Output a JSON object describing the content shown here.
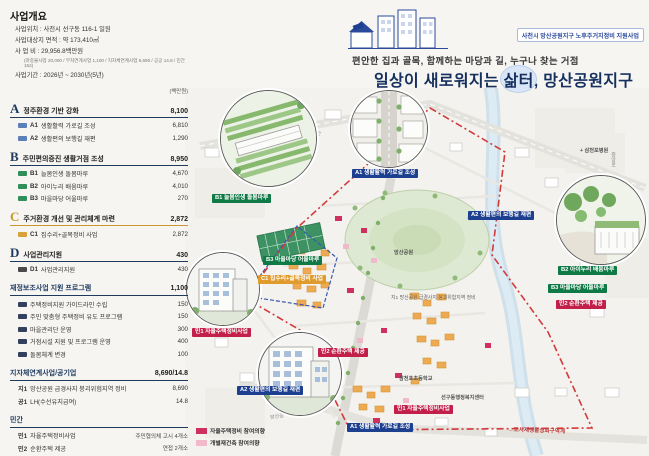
{
  "overview": {
    "title": "사업개요",
    "rows": [
      {
        "label": "사업위치",
        "value": "사천시 선구동 116-1 일원"
      },
      {
        "label": "사업대상지 면적",
        "value": "약 173,410㎡"
      },
      {
        "label": "사 업 비",
        "value": "29,956.8백만원",
        "note": "(마중물사업 20,000 / 부처연계사업 1,100 / 지자체연계사업 8,690 / 공공 14.8 / 민간 152)"
      },
      {
        "label": "사업기간",
        "value": "2026년 ~ 2030년(5년)"
      }
    ]
  },
  "budget": {
    "unit": "(백만원)",
    "sections": [
      {
        "code": "A",
        "title": "정주환경 기반 강화",
        "total": "8,100",
        "items": [
          {
            "code": "A1",
            "name": "생활활력 가로길 조성",
            "value": "6,810"
          },
          {
            "code": "A2",
            "name": "생활편의 보행길 재편",
            "value": "1,290"
          }
        ]
      },
      {
        "code": "B",
        "title": "주민편의증진 생활거점 조성",
        "total": "8,950",
        "items": [
          {
            "code": "B1",
            "name": "늘봄인생 돌봄마루",
            "value": "4,670"
          },
          {
            "code": "B2",
            "name": "아이누리 배움마루",
            "value": "4,010"
          },
          {
            "code": "B3",
            "name": "마을마당 어울마루",
            "value": "270"
          }
        ]
      },
      {
        "code": "C",
        "title": "주거환경 개선 및 관리체계 마련",
        "total": "2,872",
        "items": [
          {
            "code": "C1",
            "name": "집수리+골목정비 사업",
            "value": "2,872"
          }
        ]
      },
      {
        "code": "D",
        "title": "사업관리지원",
        "total": "430",
        "items": [
          {
            "code": "D1",
            "name": "사업관리지원",
            "value": "430"
          }
        ]
      }
    ],
    "program": {
      "title": "재정보조사업 지원 프로그램",
      "total": "1,100",
      "items": [
        {
          "name": "주택정비지원 가이드라인 수립",
          "value": "150"
        },
        {
          "name": "주민 맞춤형 주택정비 유도 프로그램",
          "value": "150"
        },
        {
          "name": "마을관리단 운영",
          "value": "300"
        },
        {
          "name": "거점시설 지원 및 프로그램 운영",
          "value": "400"
        },
        {
          "name": "돌봄체계 변경",
          "value": "100"
        }
      ]
    },
    "linked": {
      "title": "지자체연계사업/공기업",
      "total": "8,690/14.8",
      "items": [
        {
          "code": "지1",
          "name": "망산공원 급경사지 붕괴위험지역 정비",
          "value": "8,690"
        },
        {
          "code": "공1",
          "name": "LH(수선유지급여)",
          "value": "14.8"
        }
      ]
    },
    "private": {
      "title": "민간",
      "items": [
        {
          "code": "민1",
          "name": "자율주택정비사업",
          "value": "주민협의체 고시 4개소"
        },
        {
          "code": "민2",
          "name": "순환주택 제공",
          "value": "연접 2개소"
        }
      ]
    }
  },
  "header": {
    "badge": "사천시 망산공원지구 노후주거지정비 지원사업",
    "subtitle": "편안한 집과 골목, 함께하는 마당과 길, 누구나 찾는 거점",
    "title_pre": "일상이 새로워지는 ",
    "title_hl": "삶터",
    "title_post": ", 망산공원지구"
  },
  "map": {
    "labels": [
      {
        "text": "B1 늘봄인생 돌봄마루"
      },
      {
        "text": "A1 생활활력 가로길 조성"
      },
      {
        "text": "B2 아이누리 배움마루"
      },
      {
        "text": "B3 마을마당 어울마루"
      },
      {
        "text": "민2 순환주택 제공"
      },
      {
        "text": "B3 마을마당 어울마루"
      },
      {
        "text": "C1 집수리+골목정비 사업"
      },
      {
        "text": "A2 생활편의 보행길 재편"
      },
      {
        "text": "A2 생활편의 보행길 재편"
      },
      {
        "text": "A1 생활활력 가로길 조성"
      },
      {
        "text": "민1 자율주택정비사업"
      },
      {
        "text": "민1 자율주택정비사업"
      },
      {
        "text": "민2 순환주택 제공"
      },
      {
        "text": "지1 망산공원 급경사지 붕괴위험지역 정비"
      }
    ],
    "landmarks": [
      {
        "text": "+ 삼천포병원"
      },
      {
        "text": "선구동행정복지센터"
      },
      {
        "text": "삼천포초등학교"
      },
      {
        "text": "망산공원"
      }
    ],
    "roads": [
      {
        "text": "삼천포대교로"
      },
      {
        "text": "망산길"
      },
      {
        "text": "중앙로"
      }
    ],
    "region_label": "←도시재생활성화구역계",
    "legend": [
      {
        "label": "자율주택정비 참여의향",
        "color": "#cf3060"
      },
      {
        "label": "개별재건축 참여의향",
        "color": "#f2b9cc"
      }
    ]
  },
  "colors": {
    "navy": "#1e3a5f",
    "gold": "#c8972f",
    "label_green": "#0f7a45",
    "label_blue": "#1d3f8f",
    "label_orange": "#e09b2d",
    "label_red": "#c2204a",
    "boundary_red": "#d23b3b"
  }
}
